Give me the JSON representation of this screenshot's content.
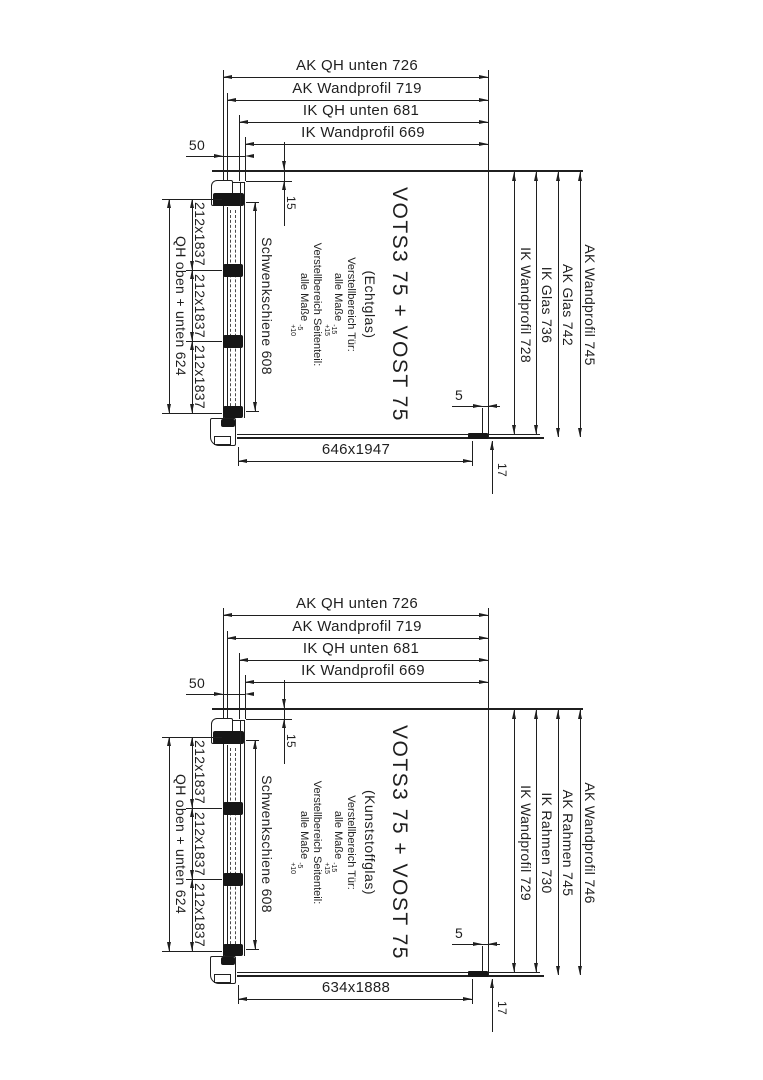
{
  "diagrams": [
    {
      "top_dims": [
        "AK QH unten 726",
        "AK Wandprofil 719",
        "IK QH unten 681",
        "IK Wandprofil 669"
      ],
      "dim_50": "50",
      "dim_15": "15",
      "left": {
        "outer": "QH oben + unten 624",
        "segments": [
          "212x1837",
          "212x1837",
          "212x1837"
        ],
        "rail": "Schwenkschiene 608"
      },
      "center": {
        "title": "VOTS3 75 + VOST 75",
        "glass": "(Echtglas)",
        "adj_door_label": "Verstellbereich Tür:",
        "adj_door_prefix": "alle Maße",
        "adj_door_tol_upper": "-15",
        "adj_door_tol_lower": "+15",
        "adj_side_label": "Verstellbereich Seitenteil:",
        "adj_side_prefix": "alle Maße",
        "adj_side_tol_upper": "-5",
        "adj_side_tol_lower": "+10"
      },
      "right_dims": [
        "IK Wandprofil 728",
        "IK Glas 736",
        "AK Glas 742",
        "AK Wandprofil 745"
      ],
      "bottom_dim": "646x1947",
      "dim_5": "5",
      "dim_17": "17"
    },
    {
      "top_dims": [
        "AK QH unten 726",
        "AK Wandprofil 719",
        "IK QH unten 681",
        "IK Wandprofil 669"
      ],
      "dim_50": "50",
      "dim_15": "15",
      "left": {
        "outer": "QH oben + unten 624",
        "segments": [
          "212x1837",
          "212x1837",
          "212x1837"
        ],
        "rail": "Schwenkschiene 608"
      },
      "center": {
        "title": "VOTS3 75 + VOST 75",
        "glass": "(Kunststoffglas)",
        "adj_door_label": "Verstellbereich Tür:",
        "adj_door_prefix": "alle Maße",
        "adj_door_tol_upper": "-15",
        "adj_door_tol_lower": "+15",
        "adj_side_label": "Verstellbereich Seitenteil:",
        "adj_side_prefix": "alle Maße",
        "adj_side_tol_upper": "-5",
        "adj_side_tol_lower": "+10"
      },
      "right_dims": [
        "IK Wandprofil 729",
        "IK Rahmen 730",
        "AK Rahmen 745",
        "AK Wandprofil 746"
      ],
      "bottom_dim": "634x1888",
      "dim_5": "5",
      "dim_17": "17"
    }
  ]
}
